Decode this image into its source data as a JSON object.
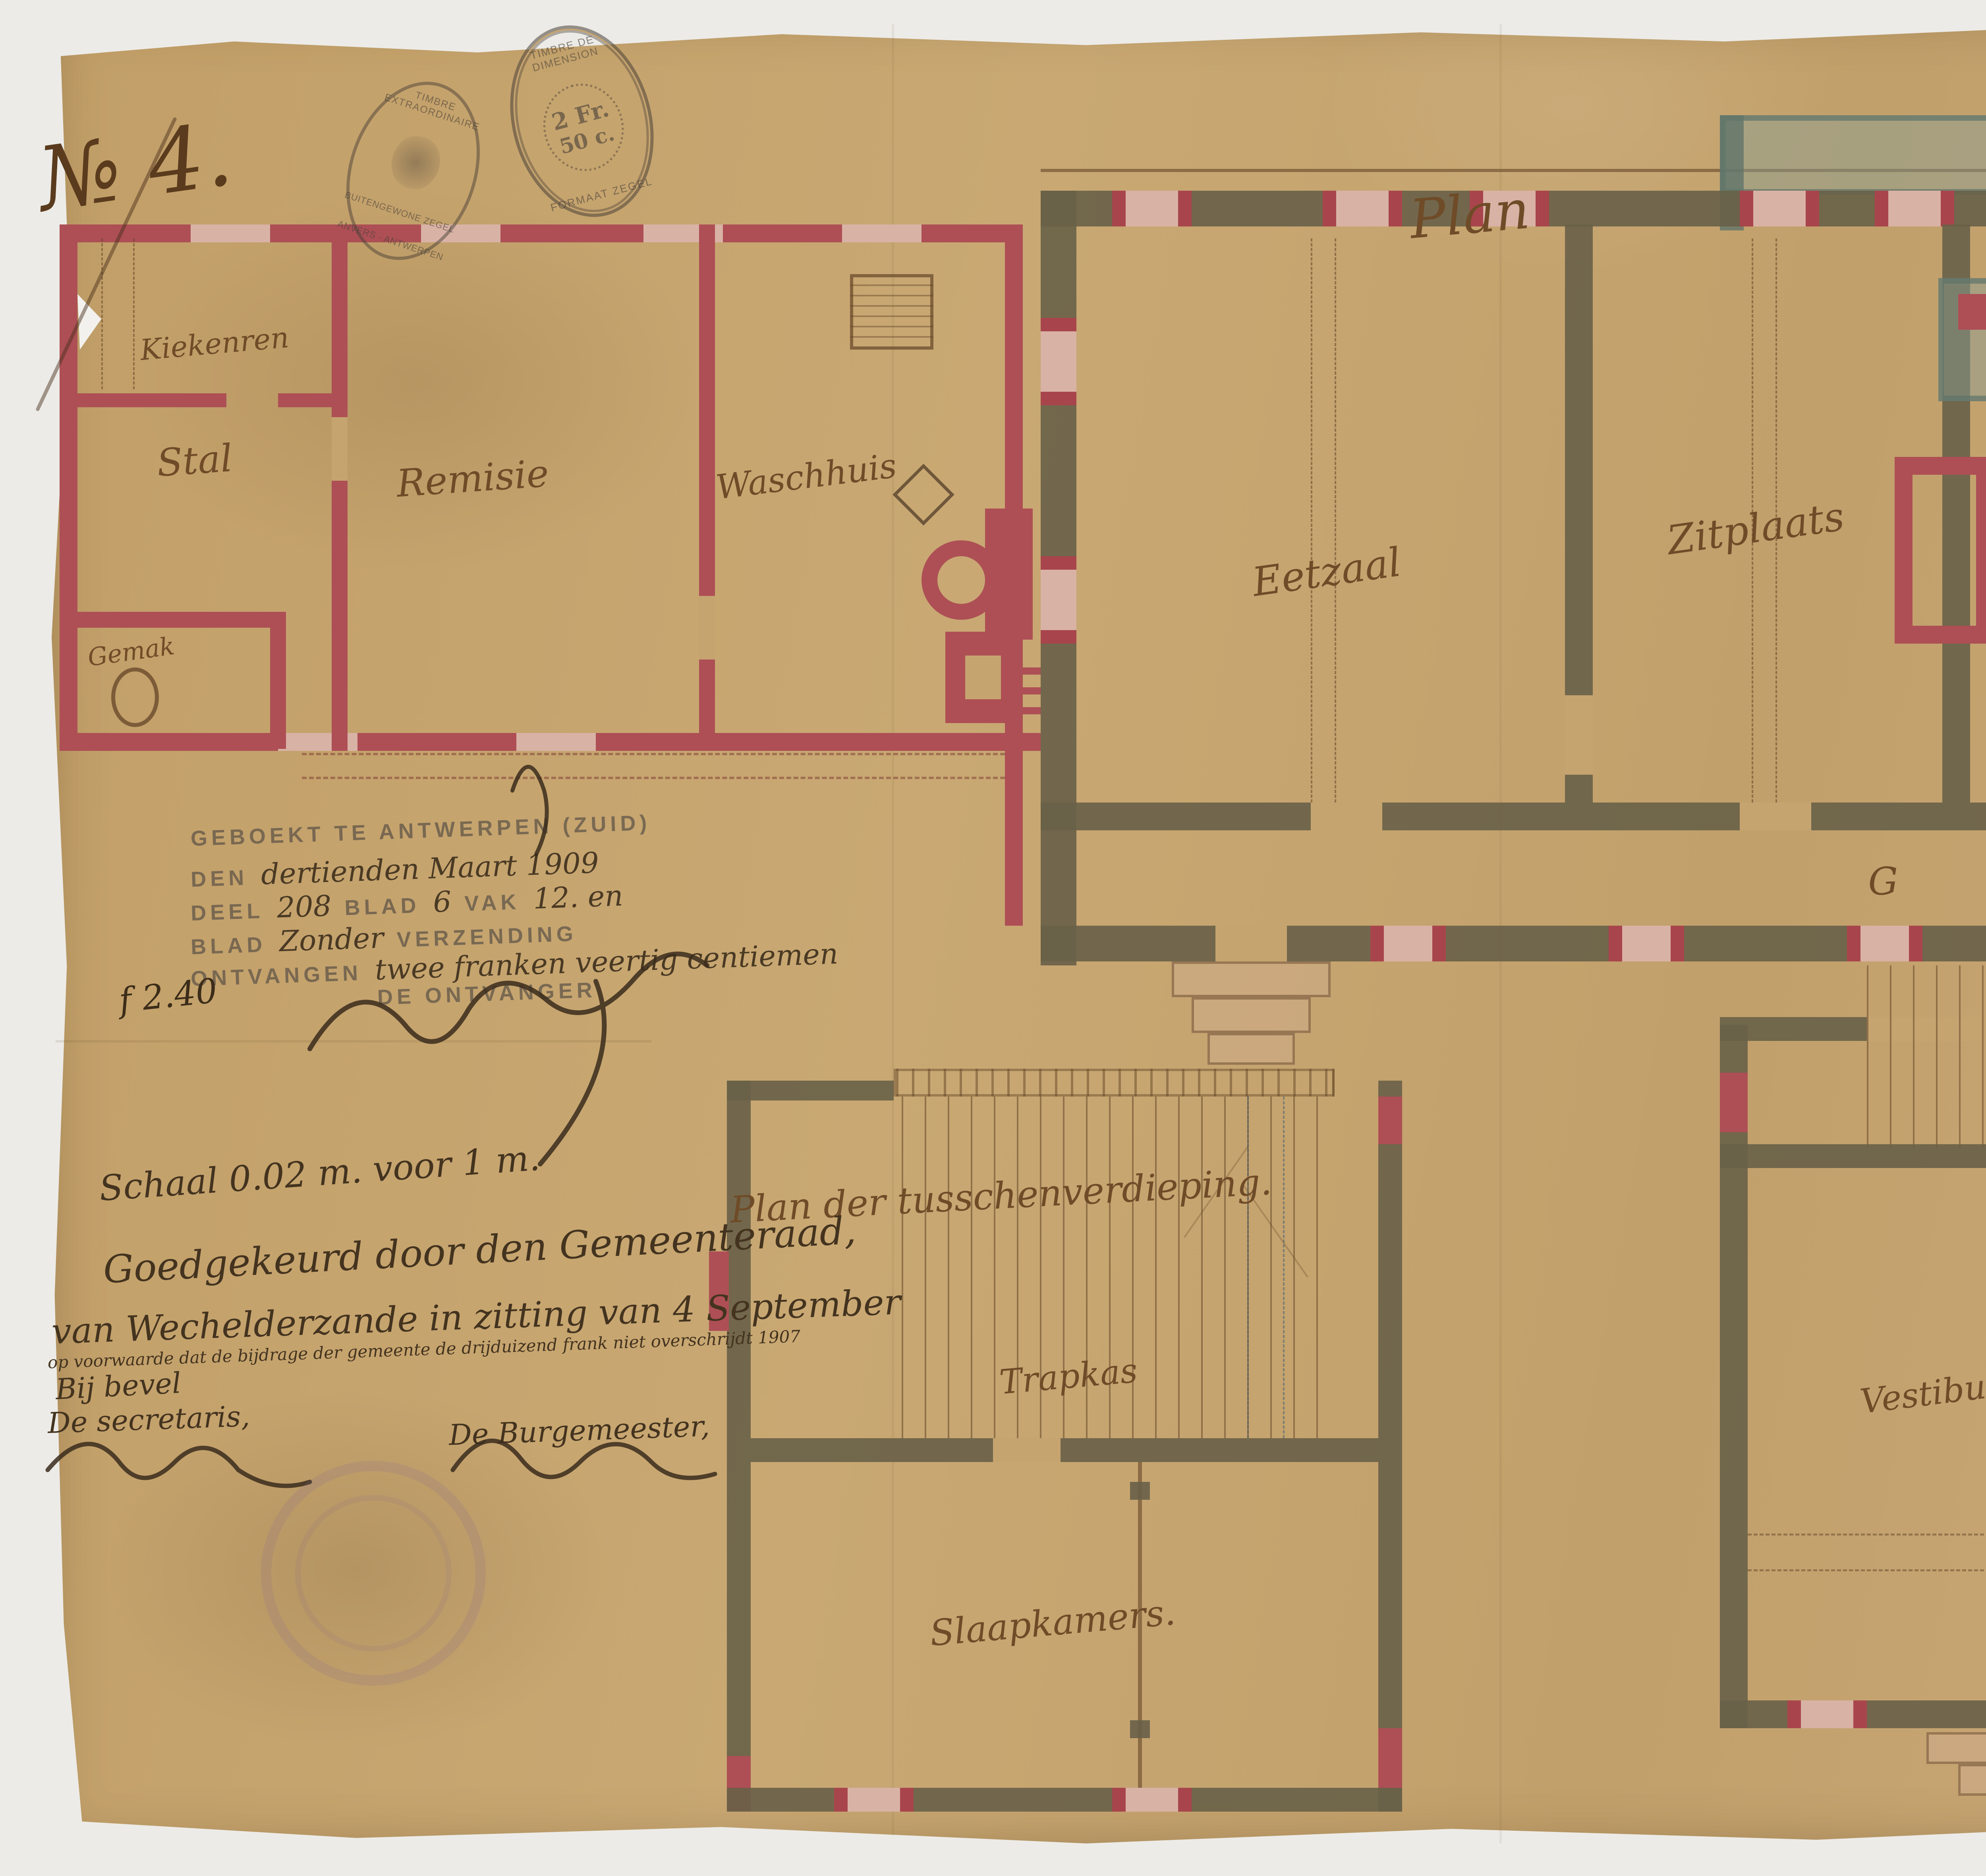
{
  "colors": {
    "page_background": "#ecebe7",
    "paper": "#c6a470",
    "ink_sepia": "#6f4b28",
    "ink_dark": "#43331f",
    "wall_dark_olive": "#686148",
    "wall_brick_red": "#ad4f55",
    "window_pink": "#d9b2a6",
    "terrace_green": "#8aa196",
    "stamp_red": "#b24252",
    "stamp_gray": "#5c5246"
  },
  "header": {
    "sheet_number": "№ 4.",
    "plan_title": "Plan"
  },
  "revenue_stamps": {
    "left": {
      "top_text": "TIMBRE EXTRAORDINAIRE",
      "middle_text": "BUITENGEWONE ZEGEL",
      "bottom_text": "ANVERS · ANTWERPEN"
    },
    "right": {
      "top_text": "TIMBRE DE DIMENSION",
      "value_line1": "2 Fr.",
      "value_line2": "50 c.",
      "bottom_text": "FORMAAT ZEGEL"
    }
  },
  "registration": {
    "line1": "GEBOEKT TE ANTWERPEN (ZUID)",
    "line2_label": "DEN",
    "line2_value": "dertienden Maart 1909",
    "line3_label1": "DEEL",
    "line3_value1": "208",
    "line3_label2": "BLAD",
    "line3_value2": "6",
    "line3_label3": "VAK",
    "line3_value3": "12. en",
    "line4_label1": "BLAD",
    "line4_value": "Zonder",
    "line4_label2": "VERZENDING",
    "line5_label": "ONTVANGEN",
    "line5_value": "twee franken veertig centiemen",
    "line6": "DE ONTVANGER",
    "fee": "f 2.40"
  },
  "labels": {
    "kiekenren": "Kiekenren",
    "stal": "Stal",
    "remise": "Remisie",
    "waschhuis": "Waschhuis",
    "gemak_outbuilding": "Gemak",
    "eetzaal": "Eetzaal",
    "zitplaats": "Zitplaats",
    "keuken": "Keuken",
    "zaal": "Zaal",
    "gang": "Gang",
    "trapkas_main": "Trapkas",
    "gemak_mezz": "Gemak",
    "vestibule": "Vestibule",
    "spreekkamer": "Spreekkamer",
    "mezz_title": "Plan der tusschenverdieping.",
    "trapkas_left": "Trapkas",
    "slaapkamers": "Slaapkamers.",
    "building_title": "Pastorij te Wechelderzande."
  },
  "approval": {
    "scale_note": "Schaal 0.02 m. voor 1 m.",
    "line1": "Goedgekeurd door den Gemeenteraad,",
    "line2": "van Wechelderzande in zitting van 4 September",
    "condition": "op voorwaarde dat de bijdrage der gemeente de drijduizend frank niet overschrijdt  1907",
    "by_order": "Bij bevel",
    "secretary_label": "De secretaris,",
    "burgomaster_label": "De Burgemeester,"
  },
  "commission": {
    "line1": "Nagezien door den Koninklijken",
    "line2": "Raad voor Kunstgebouwen in zijne zitting",
    "line3_label": "van",
    "line3_value": "den 2 february 1907.",
    "line4_label": "ziet het verslag van",
    "line4_value": "den 6 dezer maand, № 4686.",
    "clerk_label": "De Schrijver,",
    "chairman_label": "De Voorzitter,",
    "clerk_signature": "A. Massaux"
  }
}
